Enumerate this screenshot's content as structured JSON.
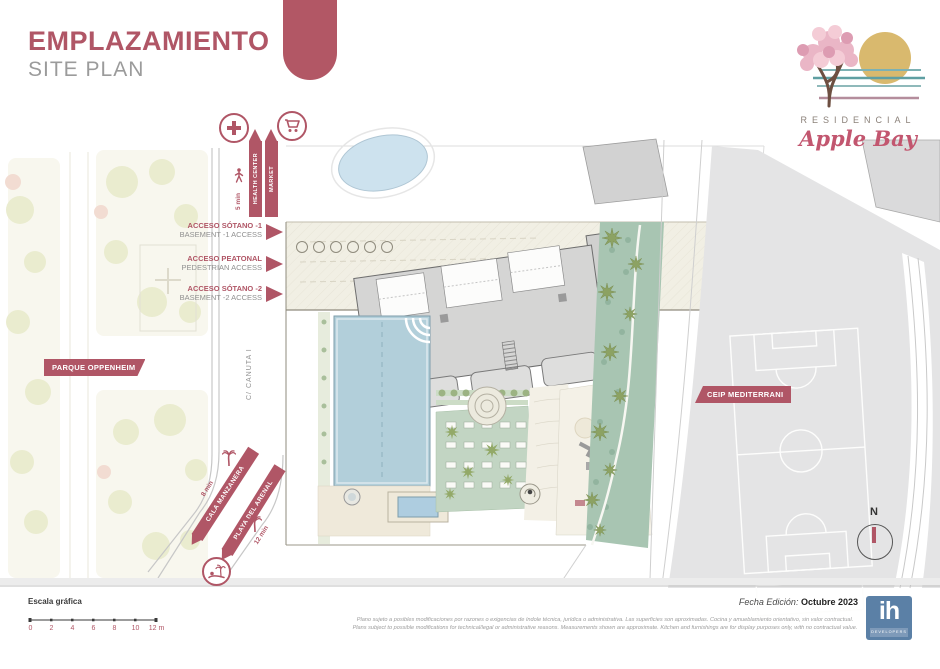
{
  "colors": {
    "brand_maroon": "#b05666",
    "subtitle_gray": "#9b9b9b",
    "logo_teal": "#5f9fa2",
    "logo_mauve": "#b48d9c",
    "logo_sun": "#d9b96e",
    "pool_blue": "#b3d0da",
    "landscape_green": "#a8c5b3",
    "developer_blue": "#5b80a6"
  },
  "header": {
    "title": "EMPLAZAMIENTO",
    "subtitle": "SITE PLAN"
  },
  "brand": {
    "residencial": "RESIDENCIAL",
    "name": "Apple Bay"
  },
  "plan": {
    "street_label": "C/ CANUTA I",
    "park_ribbon": "PARQUE OPPENHEIM",
    "school_ribbon": "CEIP MEDITERRANI",
    "health_bar": "HEALTH CENTER",
    "market_bar": "MARKET",
    "walk_time_top": "5 min",
    "beach_bar_1": "CALA MANZANERA",
    "beach_bar_2": "PLAYA DEL ARENAL",
    "walk_time_beach_1": "8 min",
    "walk_time_beach_2": "12 min",
    "compass": "N",
    "access": [
      {
        "es": "ACCESO SÓTANO -1",
        "en": "BASEMENT -1 ACCESS"
      },
      {
        "es": "ACCESO PEATONAL",
        "en": "PEDESTRIAN ACCESS"
      },
      {
        "es": "ACCESO SÓTANO -2",
        "en": "BASEMENT -2 ACCESS"
      }
    ]
  },
  "footer": {
    "scale_title": "Escala gráfica",
    "scale_ticks": [
      "0",
      "2",
      "4",
      "6",
      "8",
      "10",
      "12 m"
    ],
    "edition_label": "Fecha Edición:",
    "edition_value": "Octubre 2023",
    "disclaimer_es": "Plano sujeto a posibles modificaciones por razones o exigencias de índole técnica, jurídica o administrativa. Las superficies son aproximadas. Cocina y amueblamiento orientativo, sin valor contractual.",
    "disclaimer_en": "Plans subject to possible modifications for technical/legal or administrative reasons. Measurements shown are approximate. Kitchen and furnishings are for display purposes only, with no contractual value.",
    "developer": "ih",
    "developer_sub": "DEVELOPERS"
  }
}
